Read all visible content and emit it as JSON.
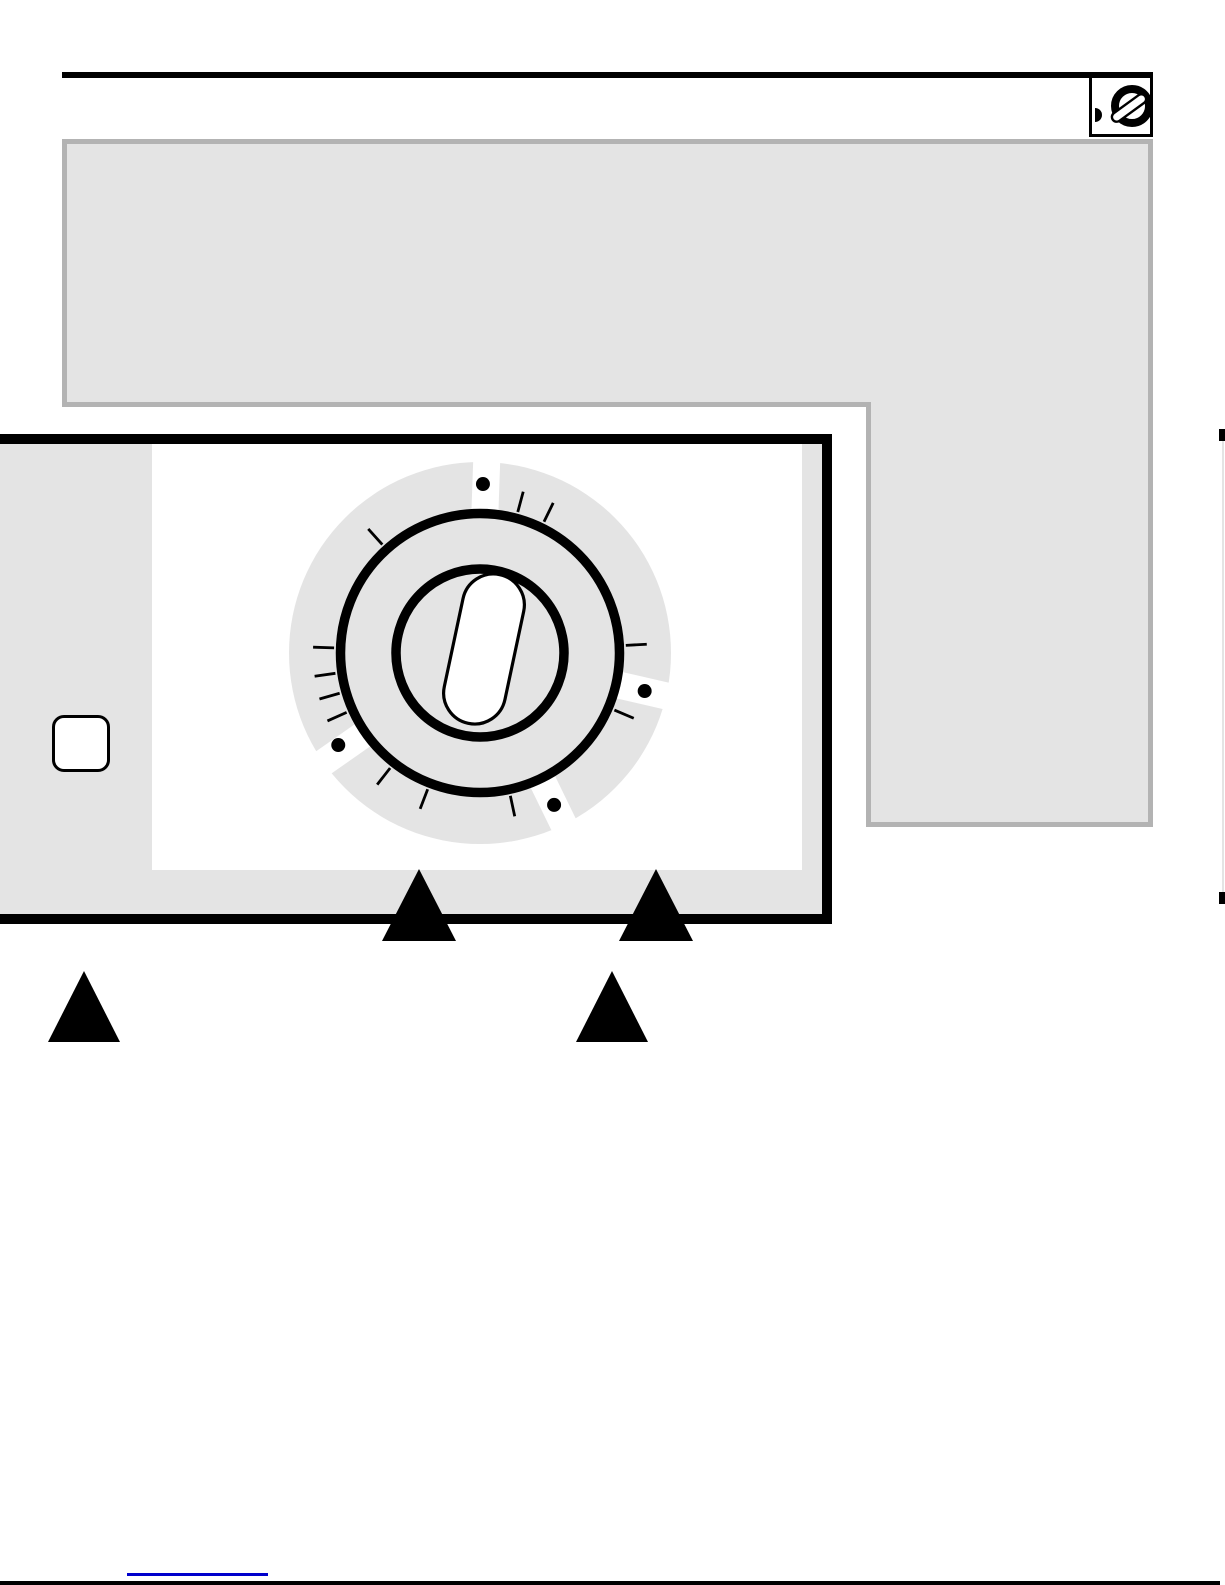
{
  "page": {
    "width": 1225,
    "height": 1585,
    "background": "#ffffff",
    "visible_text": ""
  },
  "colors": {
    "black": "#000000",
    "panel_gray": "#e4e4e4",
    "callout_border_gray": "#b3b3b3",
    "white": "#ffffff",
    "link_blue": "#0000cc",
    "edge_line_gray": "#e4e4e4"
  },
  "header": {
    "rule": {
      "x": 62,
      "y": 72,
      "w": 1091,
      "h": 6
    },
    "icon_box": {
      "x": 1089,
      "y": 75,
      "w": 64,
      "h": 62,
      "icon": "rotary-knob-icon",
      "latch_dot": {
        "w": 7,
        "h": 14
      },
      "knob": {
        "ring_center": [
          40,
          28
        ],
        "ring_radius": 17,
        "ring_stroke": 8,
        "slash": {
          "cx": 37,
          "cy": 30,
          "w": 40,
          "h": 9.5,
          "rx": 4.75,
          "rotate": -36,
          "stroke": 2.4
        }
      }
    }
  },
  "callout_region": {
    "shape": "L",
    "fill": "#e4e4e4",
    "border": "#b3b3b3",
    "border_w": 5,
    "path": "M64.5,141.5 H1150.5 V824.5 H868.5 V404.5 H64.5 Z"
  },
  "control_panel": {
    "outer": {
      "x": -10,
      "y": 434,
      "w": 822,
      "h": 470,
      "border_w": 10
    },
    "side_strip_w": 152,
    "white_face": {
      "x": 152,
      "y": 444,
      "w": 650,
      "h": 426
    },
    "side_button": {
      "x": 52,
      "y": 715,
      "w": 58,
      "h": 57,
      "radius": 12
    }
  },
  "dial": {
    "svg_origin": [
      270,
      443
    ],
    "center_local": [
      200,
      200
    ],
    "disc": {
      "radius": 191,
      "fill": "#e4e4e4"
    },
    "slots": {
      "angles": [
        2,
        103,
        154,
        235
      ],
      "width": 27,
      "r1": 135,
      "r2": 212,
      "color": "#ffffff"
    },
    "outer_ring": {
      "radius": 139.5,
      "stroke": 9.5
    },
    "inner_ring": {
      "radius": 84,
      "stroke": 9.5
    },
    "ticks": {
      "angles": [
        15,
        26,
        87,
        113,
        168,
        201,
        218,
        246,
        254,
        262,
        272,
        318
      ],
      "r1": 146,
      "r2": 167,
      "stroke": 2.8
    },
    "dots": {
      "angles": [
        1,
        103,
        154,
        237
      ],
      "dist": 169,
      "radius": 7
    },
    "knob_capsule": {
      "dx": 4,
      "dy": -4,
      "w": 62,
      "h": 152,
      "rotate": 12,
      "stroke": 3.2
    }
  },
  "pointer_triangles": [
    {
      "x": 382,
      "y": 869,
      "w": 74,
      "h": 72
    },
    {
      "x": 619,
      "y": 869,
      "w": 74,
      "h": 72
    },
    {
      "x": 48,
      "y": 971,
      "w": 72,
      "h": 71
    },
    {
      "x": 576,
      "y": 971,
      "w": 72,
      "h": 71
    }
  ],
  "right_edge_marker": {
    "line": {
      "x": 1222,
      "y1": 434,
      "y2": 903
    },
    "caps": [
      {
        "y": 429
      },
      {
        "y": 892
      }
    ]
  },
  "footer": {
    "link_underline": {
      "x": 127,
      "y": 1573,
      "w": 141
    },
    "bottom_edge": {
      "w": 1220,
      "h": 4
    }
  }
}
